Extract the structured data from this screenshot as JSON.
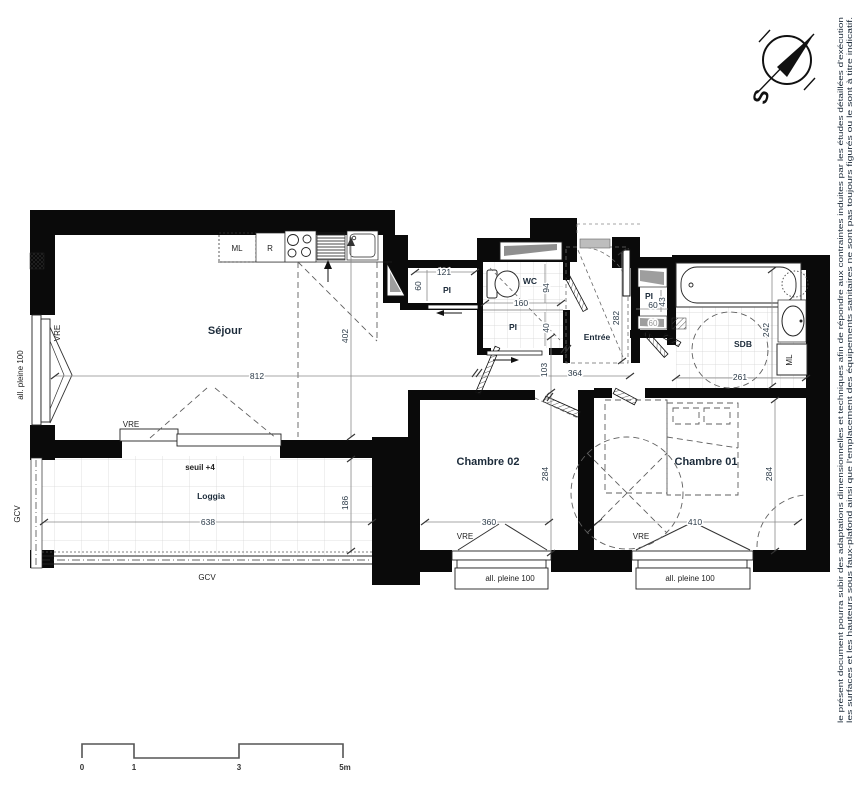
{
  "rooms": {
    "sejour": "Séjour",
    "wc": "WC",
    "entree": "Entrée",
    "sdb": "SDB",
    "chambre01": "Chambre 01",
    "chambre02": "Chambre 02",
    "loggia": "Loggia",
    "seuil": "seuil +4"
  },
  "closets": {
    "pi1": "PI",
    "pi2": "PI",
    "pi3": "PI"
  },
  "appliances": {
    "ml_kitchen": "ML",
    "fridge": "R",
    "ml_sdb": "ML"
  },
  "openings": {
    "vre_left": "VRE",
    "vre_sejour": "VRE",
    "vre_ch02": "VRE",
    "vre_ch01": "VRE",
    "allege_left": "all. pleine 100",
    "allege_ch02": "all. pleine 100",
    "allege_ch01": "all. pleine 100",
    "gcv_bottom": "GCV",
    "gcv_left": "GCV"
  },
  "dims": {
    "sejour_w": "812",
    "sejour_h": "402",
    "pi1_w": "121",
    "pi1_d": "60",
    "wc_w": "160",
    "wc_d": "94",
    "pi2_d": "40",
    "entree_l": "282",
    "hall_w": "364",
    "hall_d": "103",
    "pi3_w": "60",
    "pi3_d": "43",
    "pi3_w2": "60",
    "sdb_w": "261",
    "sdb_l": "242",
    "ch02_w": "360",
    "ch02_l": "284",
    "ch01_w": "410",
    "ch01_l": "284",
    "loggia_w": "638",
    "loggia_d": "186"
  },
  "scalebar": {
    "t0": "0",
    "t1": "1",
    "t3": "3",
    "t5": "5m"
  },
  "compass": {
    "south": "S"
  },
  "disclaimer": {
    "line1": "le présent document pourra subir des adaptations dimensionnelles et techniques afin de répondre aux contraintes induites par les études détaillées d'exécution",
    "line2": "les surfaces et les hauteurs sous faux-plafond ainsi que l'emplacement des équipements sanitaires ne sont pas toujours figurés ou le sont à titre indicatif."
  }
}
